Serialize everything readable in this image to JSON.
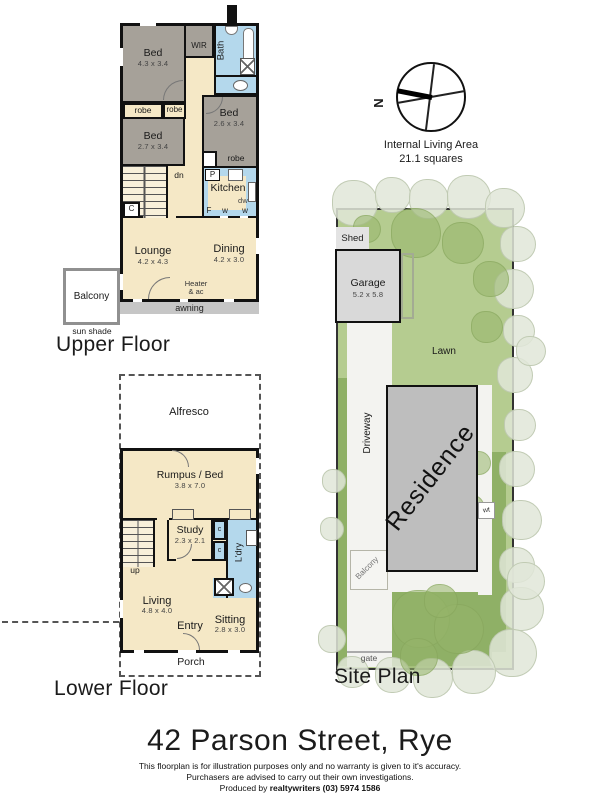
{
  "title": "42 Parson Street, Rye",
  "disclaimer": {
    "line1": "This floorplan is for illustration purposes only and no warranty is given to it's accuracy.",
    "line2": "Purchasers are advised to carry out their own investigations.",
    "line3_prefix": "Produced by ",
    "line3_bold": "realtywriters (03) 5974 1586"
  },
  "compass": {
    "north": "N",
    "caption1": "Internal Living Area",
    "caption2": "21.1 squares"
  },
  "upper_floor": {
    "label": "Upper Floor",
    "bed1": {
      "name": "Bed",
      "dims": "4.3 x 3.4"
    },
    "wir": "WIR",
    "bath": "Bath",
    "robe_left": "robe",
    "robe_mid": "robe",
    "bed2": {
      "name": "Bed",
      "dims": "2.7 x 3.4"
    },
    "bed3": {
      "name": "Bed",
      "dims": "2.6 x 3.4"
    },
    "robe3": "robe",
    "stairs": "dn",
    "cupboard": "C",
    "kitchen": "Kitchen",
    "pantry": "P",
    "fridge": "F",
    "dishwasher": "dw",
    "window_a": "w",
    "window_b": "w",
    "lounge": {
      "name": "Lounge",
      "dims": "4.2 x 4.3"
    },
    "dining": {
      "name": "Dining",
      "dims": "4.2 x 3.0"
    },
    "heater1": "Heater",
    "heater2": "& ac",
    "balcony": "Balcony",
    "sun_shade": "sun shade",
    "awning": "awning"
  },
  "lower_floor": {
    "label": "Lower Floor",
    "alfresco": "Alfresco",
    "rumpus": {
      "name": "Rumpus / Bed",
      "dims": "3.8 x 7.0"
    },
    "study": {
      "name": "Study",
      "dims": "2.3 x 2.1"
    },
    "cupboard_a": "c",
    "cupboard_b": "c",
    "laundry": "L'dry",
    "stairs": "up",
    "living": {
      "name": "Living",
      "dims": "4.8 x 4.0"
    },
    "entry": "Entry",
    "sitting": {
      "name": "Sitting",
      "dims": "2.8 x 3.0"
    },
    "porch": "Porch"
  },
  "site_plan": {
    "label": "Site Plan",
    "shed": "Shed",
    "garage": {
      "name": "Garage",
      "dims": "5.2 x 5.8"
    },
    "lawn": "Lawn",
    "driveway": "Driveway",
    "residence": "Residence",
    "balcony": "Balcony",
    "wt": "wt",
    "gate": "gate"
  },
  "colors": {
    "floor_beige": "#F5E8C6",
    "bedroom_gray": "#A6A199",
    "wet_area_blue": "#B4D8EC",
    "wall_black": "#111111",
    "site_green": "#B5CC90",
    "hedge_green": "#8FB066",
    "tree_pale": "#E1E6D8",
    "residence_gray": "#BEBEBE",
    "garage_gray": "#D9D9D9",
    "paving_white": "#F3F3F0"
  }
}
